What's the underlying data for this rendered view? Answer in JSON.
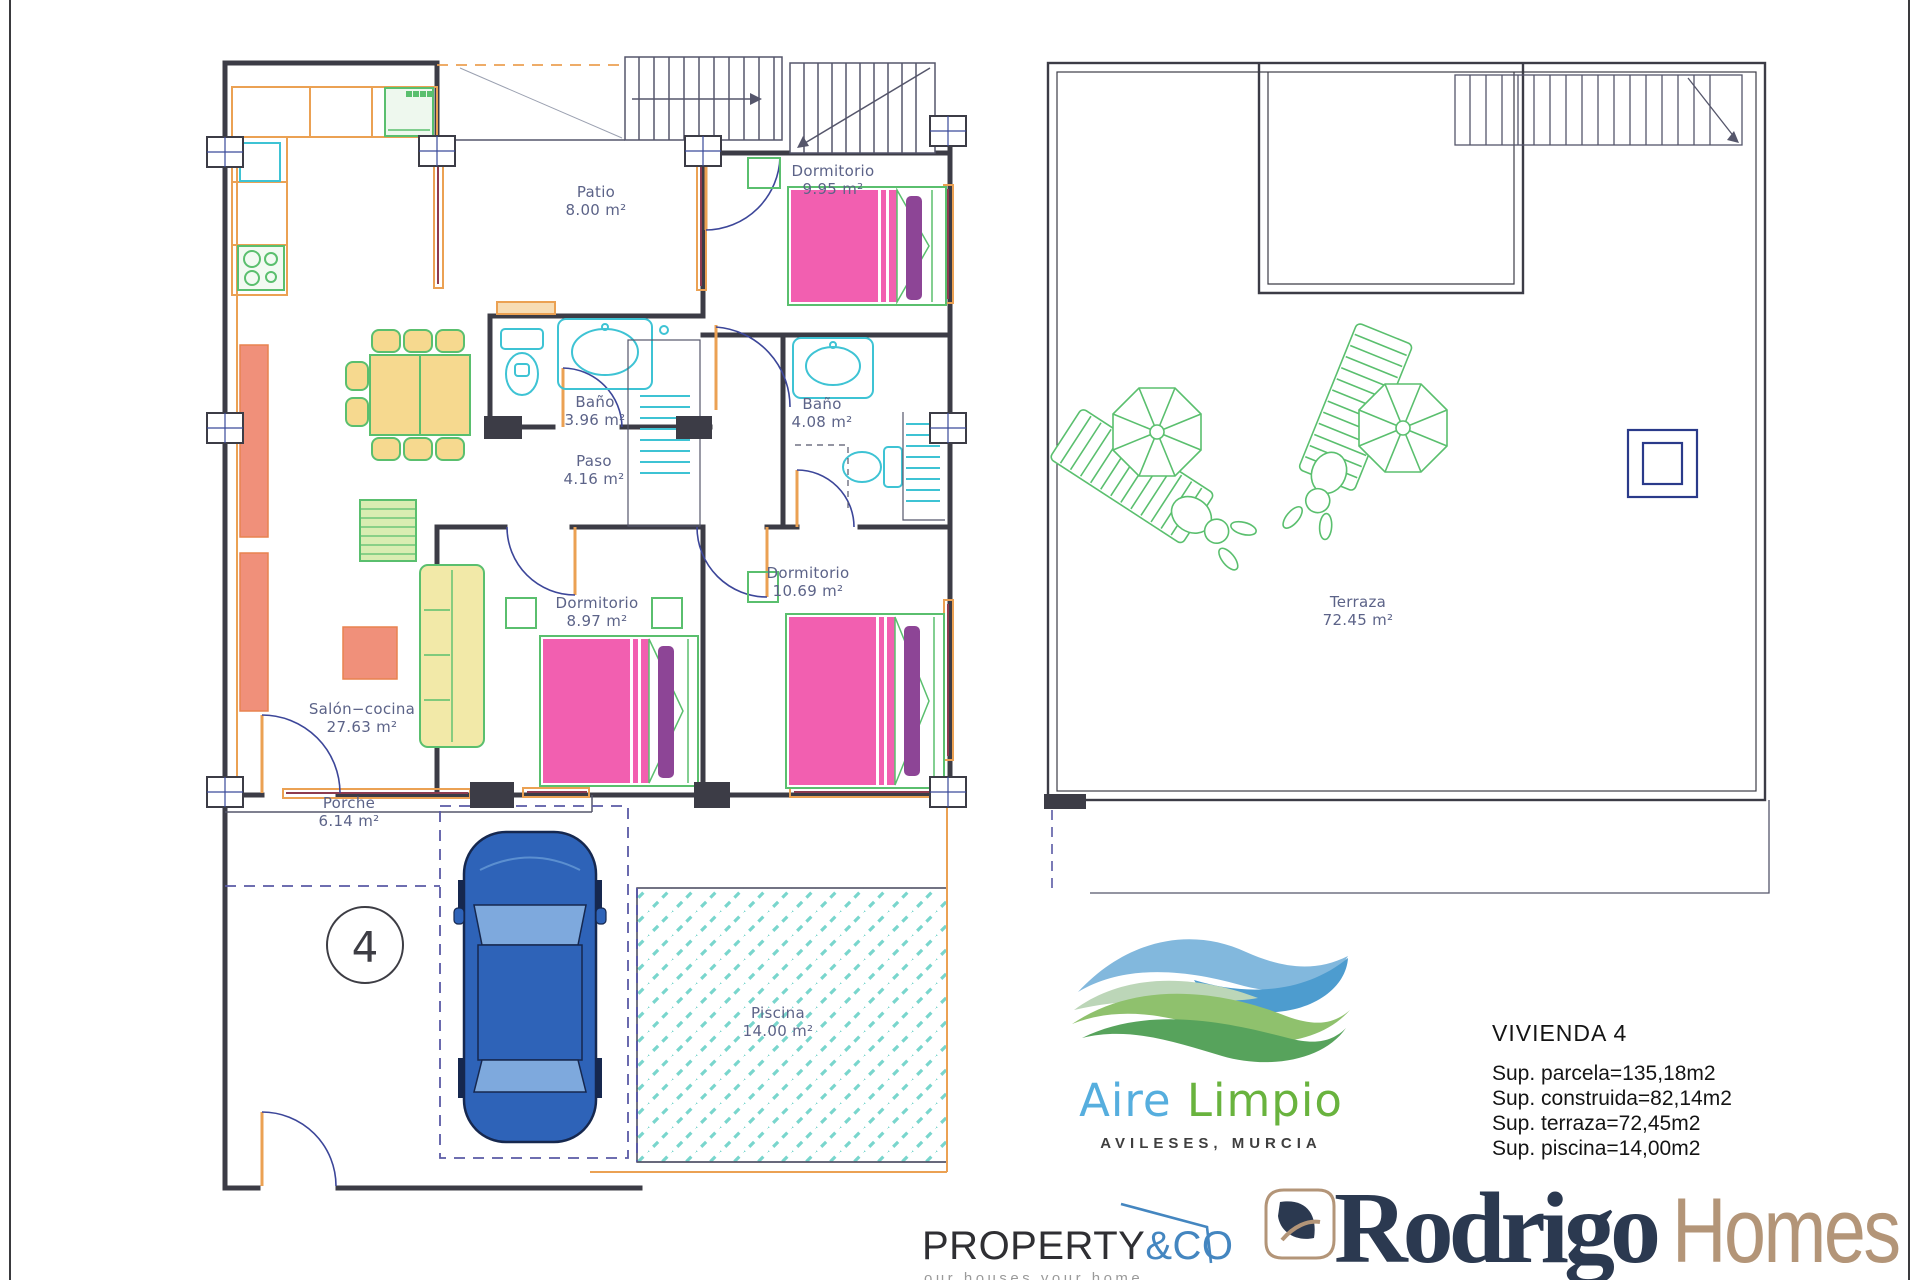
{
  "plan_ground": {
    "unit_number": "4",
    "rooms": [
      {
        "id": "patio",
        "name": "Patio",
        "area": "8.00 m²"
      },
      {
        "id": "dormitorio-top",
        "name": "Dormitorio",
        "area": "9.95 m²"
      },
      {
        "id": "bano-1",
        "name": "Baño",
        "area": "3.96 m²"
      },
      {
        "id": "bano-2",
        "name": "Baño",
        "area": "4.08 m²"
      },
      {
        "id": "paso",
        "name": "Paso",
        "area": "4.16 m²"
      },
      {
        "id": "dormitorio-mid",
        "name": "Dormitorio",
        "area": "8.97 m²"
      },
      {
        "id": "dormitorio-right",
        "name": "Dormitorio",
        "area": "10.69 m²"
      },
      {
        "id": "salon-cocina",
        "name": "Salón−cocina",
        "area": "27.63 m²"
      },
      {
        "id": "porche",
        "name": "Porche",
        "area": "6.14 m²"
      },
      {
        "id": "piscina",
        "name": "Piscina",
        "area": "14.00 m²"
      }
    ]
  },
  "plan_terrace": {
    "rooms": [
      {
        "id": "terraza",
        "name": "Terraza",
        "area": "72.45 m²"
      }
    ]
  },
  "info": {
    "title": "VIVIENDA 4",
    "lines": [
      "Sup.  parcela=135,18m2",
      "Sup.  construida=82,14m2",
      "Sup.  terraza=72,45m2",
      "Sup.  piscina=14,00m2"
    ]
  },
  "brand_aire_limpio": {
    "word1": "Aire",
    "word2": "Limpio",
    "subtitle": "AVILESES, MURCIA"
  },
  "brand_property_co": {
    "word1": "PROPERTY",
    "word2": "&CO",
    "tagline": "our houses your home"
  },
  "brand_rodrigo_homes": {
    "word1": "Rodrigo",
    "word2": "Homes"
  },
  "colors": {
    "wall": "#3c3c46",
    "carpentry_orange": "#eba153",
    "glazing_maroon": "#8e3b4f",
    "fixture_cyan": "#3ec3d4",
    "bed_pink": "#f25fb0",
    "bed_purple": "#8d4596",
    "furniture_green": "#5abf6e",
    "sofa_yellow": "#f6d98f",
    "cabinet_salmon": "#f0907a",
    "car_blue": "#2e63b8",
    "pool_teal": "#79d6cd",
    "dash_navy": "#5a5aa5",
    "label_slate": "#5c6388",
    "aire_blue": "#56aede",
    "aire_green": "#69b33e",
    "property_blue": "#4486c0",
    "rodrigo_navy": "#2b3950",
    "rodrigo_tan": "#b39578"
  }
}
